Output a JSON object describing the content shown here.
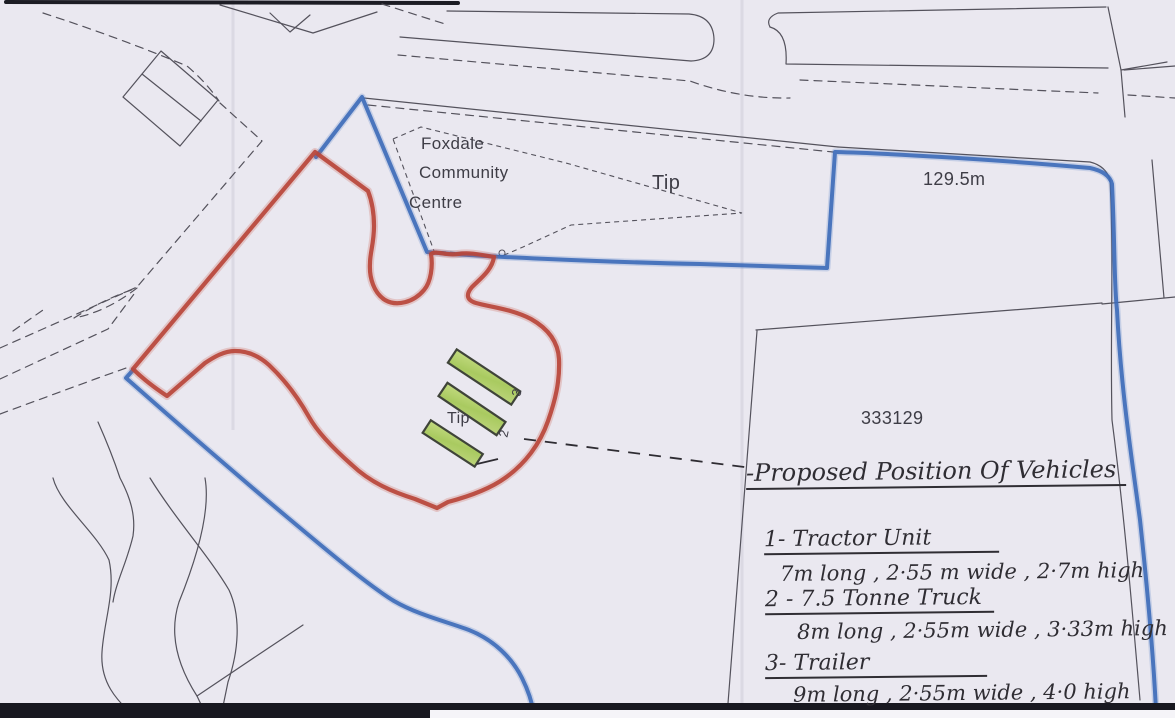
{
  "map": {
    "labels": {
      "community_centre_line1": "Foxdale",
      "community_centre_line2": "Community",
      "community_centre_line3": "Centre",
      "tip_area": "Tip",
      "tip_site": "Tip",
      "distance": "129.5m",
      "parcel_number": "333129",
      "vehicle_marker_3": "3",
      "vehicle_marker_2": "2"
    },
    "notes": {
      "title": "-Proposed Position Of Vehicles",
      "items": [
        {
          "heading": "1- Tractor Unit",
          "detail": "7m long , 2·55 m wide , 2·7m high"
        },
        {
          "heading": "2 - 7.5 Tonne Truck",
          "detail": "8m long , 2·55m wide , 3·33m high"
        },
        {
          "heading": "3- Trailer",
          "detail": "9m long , 2·55m wide , 4·0 high"
        }
      ]
    },
    "colors": {
      "site_boundary_red": "#b8453a",
      "ownership_boundary_blue": "#3c6ab8",
      "vehicle_green": "#b7d171",
      "ink": "#54525c"
    }
  }
}
